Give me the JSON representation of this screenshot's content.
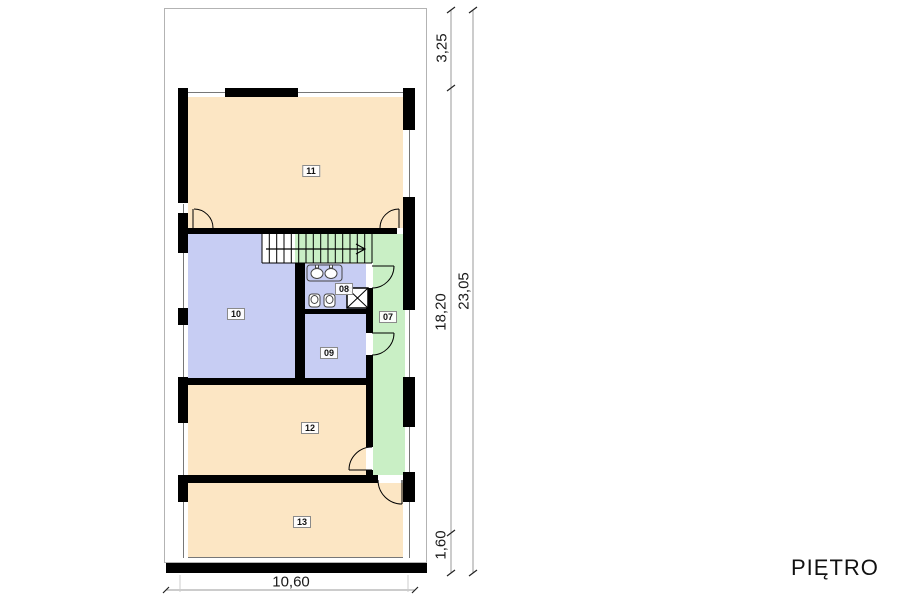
{
  "title": "PIĘTRO",
  "plan": {
    "rooms": [
      {
        "number": "07",
        "fill": "green"
      },
      {
        "number": "08",
        "fill": "lavender"
      },
      {
        "number": "09",
        "fill": "lavender"
      },
      {
        "number": "10",
        "fill": "lavender"
      },
      {
        "number": "11",
        "fill": "peach"
      },
      {
        "number": "12",
        "fill": "peach"
      },
      {
        "number": "13",
        "fill": "peach"
      }
    ],
    "dimensions": {
      "right_segments": [
        "3,25",
        "18,20",
        "1,60"
      ],
      "right_total": "23,05",
      "bottom_width": "10,60"
    },
    "icons": [
      "stairs-icon",
      "stair-direction-arrow-icon",
      "door-arc-icon",
      "sink-icon",
      "toilet-icon",
      "shower-icon",
      "window-icon"
    ]
  },
  "colors": {
    "room_peach": "#fce6c4",
    "room_lavender": "#c7cdf3",
    "room_green": "#c9efc5",
    "wall": "#000000",
    "dim_line": "#999999",
    "text": "#1a1a1a"
  }
}
